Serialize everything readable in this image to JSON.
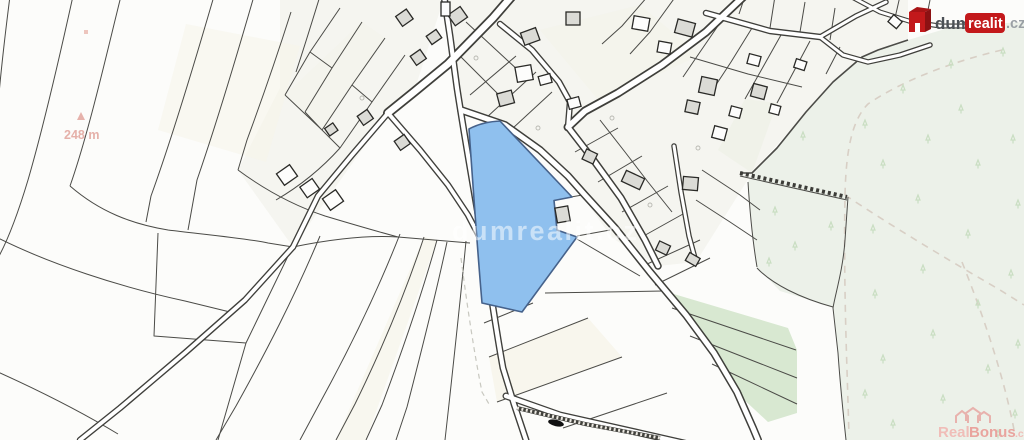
{
  "map": {
    "center_watermark": "dumrealit.cz",
    "scale_label": "248 m",
    "colors": {
      "background": "#fcfcfa",
      "village_tint": "#f5f5f0",
      "forest": "#ecf1e9",
      "meadow": "#d8e8d1",
      "field_cream": "#f6f4e9",
      "parcel_line": "#4b4b47",
      "road_casing": "#3f3f3b",
      "road_fill": "#ffffff",
      "building_fill": "#dbdbd6",
      "highlight_fill": "#8fc0ee",
      "highlight_stroke": "#46628b",
      "tree": "#c9dec2",
      "dashed_boundary": "#d8cfc5",
      "scale_text": "#e2a49c"
    }
  },
  "logo": {
    "name": "dumrealit.cz",
    "part_dum": "dum",
    "part_realit": "realit",
    "part_cz": ".cz",
    "red": "#c3191b",
    "dark_red": "#8c1113",
    "roof_red": "#a91416",
    "dum_color": "#4c5156",
    "cz_color": "#9aa0a5"
  },
  "realbonus": {
    "part_real": "Real",
    "part_bonus": "Bonus",
    "part_cz": ".cz",
    "color_real": "#f0bdb8",
    "color_bonus": "#e9a49e",
    "color_icon": "#e8b2ad"
  }
}
